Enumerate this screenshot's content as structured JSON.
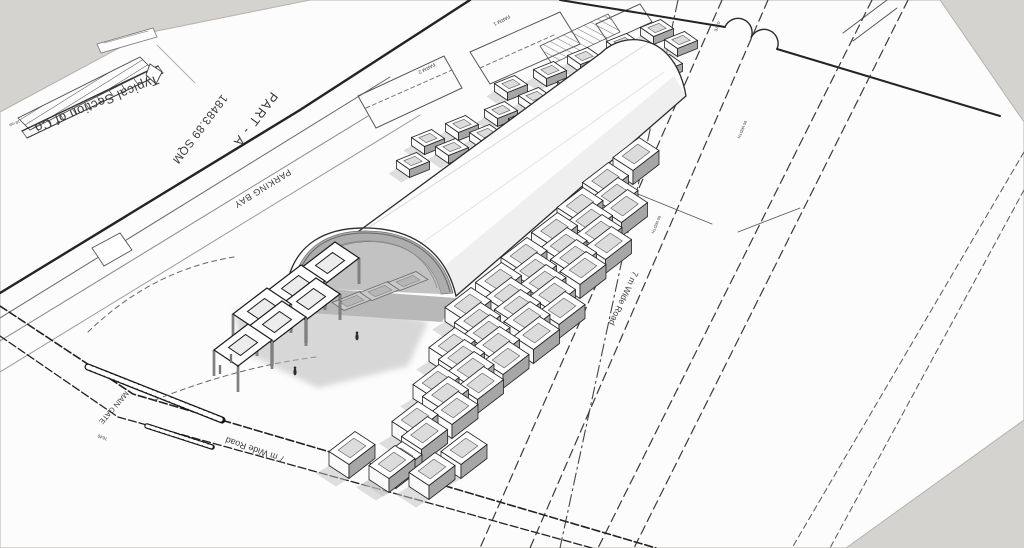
{
  "scene": {
    "background": "#d5d3cf",
    "sheet": "#fcfcfc",
    "accent_orange": "#c06f2b",
    "line_dark": "#262626",
    "bin_side": "#a6a6a6",
    "shadow": "#bdbdbd"
  },
  "labels": {
    "part": "PART - A",
    "area": "18483.89 SQM",
    "section_title": "Typical Section of Co",
    "parking": "PARKING BAY",
    "main_gate": "MAIN GATE",
    "road_left": "7 m Wide Road",
    "road_right": "7 m Wide Road",
    "plot_a": "FARM 1",
    "plot_b": "FARM 2",
    "dim_section": "18 mtr",
    "dim_road_a": "60 WIDTH",
    "dim_road_b": "60 WIDTH",
    "dim_corner": "7640",
    "gate_note": "GATE"
  },
  "model": {
    "fields": [
      {
        "name": "near-bins",
        "origin": [
          470,
          305
        ],
        "u": [
          27.5,
          -25
        ],
        "v": [
          -18,
          38
        ],
        "cols": 9,
        "rows": 5,
        "p": [
          13,
          -10
        ],
        "q": [
          10,
          6.5
        ],
        "depth": 14,
        "inner": 0.6,
        "shadow": [
          -13,
          8
        ],
        "skip": [
          [
            0,
            7
          ],
          [
            0,
            8
          ],
          [
            1,
            7
          ],
          [
            1,
            8
          ],
          [
            2,
            8
          ],
          [
            3,
            8
          ],
          [
            4,
            7
          ],
          [
            4,
            8
          ]
        ],
        "extras": [
          [
            352,
            448
          ],
          [
            392,
            462
          ],
          [
            432,
            469
          ],
          [
            464,
            448
          ]
        ]
      },
      {
        "name": "far-bins",
        "origin": [
          415,
          162
        ],
        "u": [
          36,
          -14
        ],
        "v": [
          13,
          -25
        ],
        "cols": 8,
        "rows": 3,
        "p": [
          10,
          -4
        ],
        "q": [
          6.5,
          4.5
        ],
        "depth": 8,
        "inner": 0.55,
        "shadow": [
          -8,
          5
        ],
        "skip": [
          [
            2,
            0
          ],
          [
            2,
            1
          ],
          [
            2,
            7
          ]
        ],
        "extras": []
      }
    ],
    "pergola": {
      "frames": [
        [
          243,
          345
        ],
        [
          277,
          322
        ],
        [
          311,
          299
        ],
        [
          262,
          309
        ],
        [
          296,
          286
        ],
        [
          330,
          263
        ]
      ],
      "p": [
        17,
        -13
      ],
      "q": [
        12,
        8
      ],
      "leg": 26,
      "inner": 0.5,
      "posts": [
        [
          231,
          363
        ],
        [
          220,
          374
        ]
      ]
    },
    "pads": [
      [
        352,
        301
      ],
      [
        380,
        291
      ],
      [
        408,
        281
      ]
    ],
    "figures": [
      [
        357,
        337
      ],
      [
        295,
        372
      ]
    ],
    "section_ticks": {
      "from": [
        22,
        131
      ],
      "to": [
        158,
        66
      ],
      "off": [
        5,
        7
      ],
      "n": 12
    }
  }
}
